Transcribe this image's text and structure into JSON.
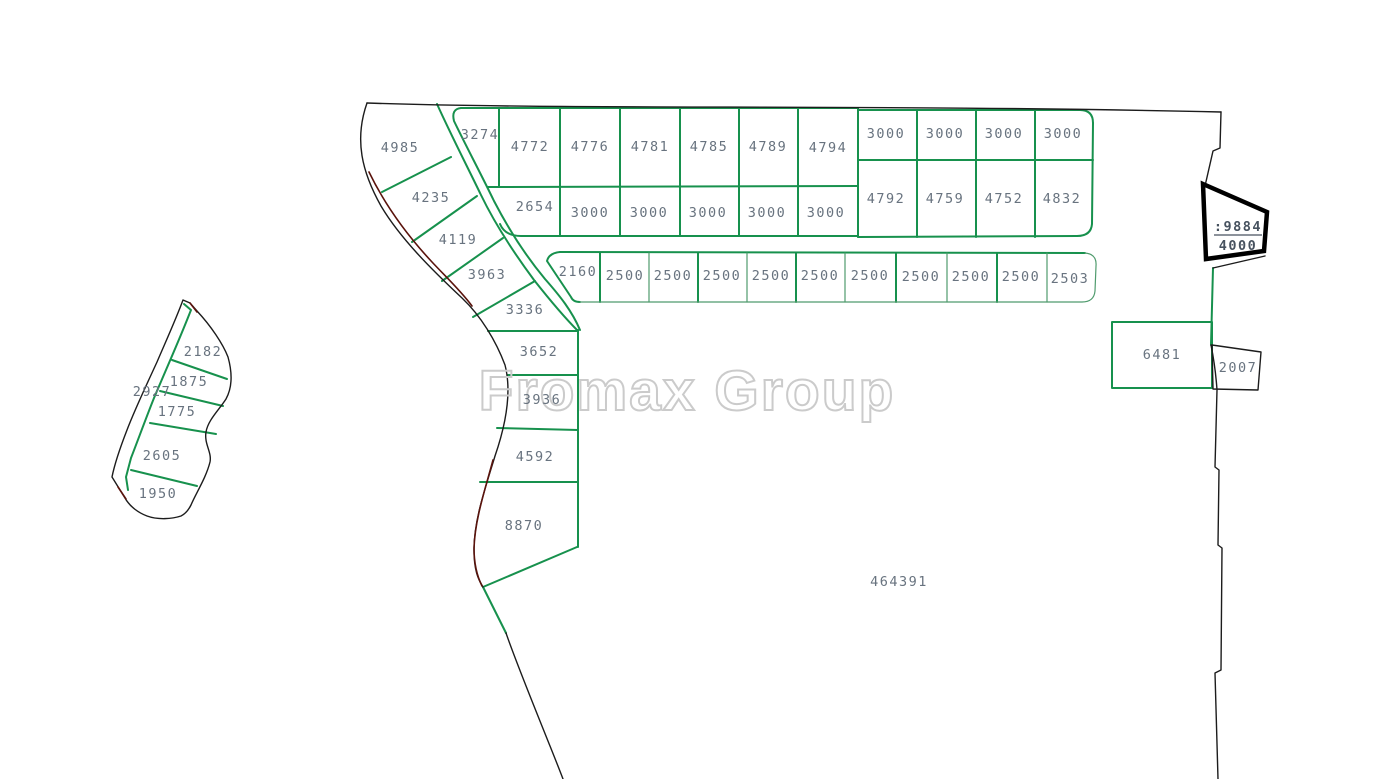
{
  "watermark": "Fromax Group",
  "colors": {
    "parcel_line": "#17914d",
    "parcel_line_thin": "#4f9b6d",
    "outer_boundary": "#1c1c1c",
    "boundary_accent": "#5a130c",
    "label_text": "#68737f",
    "highlight_text": "#47525f",
    "watermark_outline": "#cbcbcb",
    "background": "#ffffff"
  },
  "highlight_plot": {
    "label_top": ":9884",
    "label_bottom": "4000"
  },
  "zones": [
    {
      "name": "west-cluster",
      "plots": [
        {
          "area": "2182",
          "x": 203,
          "y": 356
        },
        {
          "area": "1875",
          "x": 189,
          "y": 386
        },
        {
          "area": "2927",
          "x": 152,
          "y": 396
        },
        {
          "area": "1775",
          "x": 177,
          "y": 416
        },
        {
          "area": "2605",
          "x": 162,
          "y": 460
        },
        {
          "area": "1950",
          "x": 158,
          "y": 498
        }
      ]
    },
    {
      "name": "northwest-column",
      "plots": [
        {
          "area": "4985",
          "x": 400,
          "y": 152
        },
        {
          "area": "4235",
          "x": 431,
          "y": 202
        },
        {
          "area": "4119",
          "x": 458,
          "y": 244
        },
        {
          "area": "3963",
          "x": 487,
          "y": 279
        },
        {
          "area": "3336",
          "x": 525,
          "y": 314
        }
      ]
    },
    {
      "name": "road-strip",
      "plots": [
        {
          "area": "3274",
          "x": 480,
          "y": 139
        },
        {
          "area": "2654",
          "x": 535,
          "y": 211
        }
      ]
    },
    {
      "name": "mid-column",
      "plots": [
        {
          "area": "3652",
          "x": 539,
          "y": 356
        },
        {
          "area": "3936",
          "x": 542,
          "y": 404
        },
        {
          "area": "4592",
          "x": 535,
          "y": 461
        },
        {
          "area": "8870",
          "x": 524,
          "y": 530
        }
      ]
    },
    {
      "name": "north-row-upper",
      "plots": [
        {
          "area": "4772",
          "x": 530,
          "y": 151
        },
        {
          "area": "4776",
          "x": 590,
          "y": 151
        },
        {
          "area": "4781",
          "x": 650,
          "y": 151
        },
        {
          "area": "4785",
          "x": 709,
          "y": 151
        },
        {
          "area": "4789",
          "x": 768,
          "y": 151
        },
        {
          "area": "4794",
          "x": 828,
          "y": 152
        }
      ]
    },
    {
      "name": "north-row-lower",
      "plots": [
        {
          "area": "3000",
          "x": 590,
          "y": 217
        },
        {
          "area": "3000",
          "x": 649,
          "y": 217
        },
        {
          "area": "3000",
          "x": 708,
          "y": 217
        },
        {
          "area": "3000",
          "x": 767,
          "y": 217
        },
        {
          "area": "3000",
          "x": 826,
          "y": 217
        }
      ]
    },
    {
      "name": "northeast-block-upper",
      "plots": [
        {
          "area": "3000",
          "x": 886,
          "y": 138
        },
        {
          "area": "3000",
          "x": 945,
          "y": 138
        },
        {
          "area": "3000",
          "x": 1004,
          "y": 138
        },
        {
          "area": "3000",
          "x": 1063,
          "y": 138
        }
      ]
    },
    {
      "name": "northeast-block-lower",
      "plots": [
        {
          "area": "4792",
          "x": 886,
          "y": 203
        },
        {
          "area": "4759",
          "x": 945,
          "y": 203
        },
        {
          "area": "4752",
          "x": 1004,
          "y": 203
        },
        {
          "area": "4832",
          "x": 1062,
          "y": 203
        }
      ]
    },
    {
      "name": "east-west-strip",
      "plots": [
        {
          "area": "2160",
          "x": 578,
          "y": 276
        },
        {
          "area": "2500",
          "x": 625,
          "y": 280
        },
        {
          "area": "2500",
          "x": 673,
          "y": 280
        },
        {
          "area": "2500",
          "x": 722,
          "y": 280
        },
        {
          "area": "2500",
          "x": 771,
          "y": 280
        },
        {
          "area": "2500",
          "x": 820,
          "y": 280
        },
        {
          "area": "2500",
          "x": 870,
          "y": 280
        },
        {
          "area": "2500",
          "x": 921,
          "y": 281
        },
        {
          "area": "2500",
          "x": 971,
          "y": 281
        },
        {
          "area": "2500",
          "x": 1021,
          "y": 281
        },
        {
          "area": "2503",
          "x": 1070,
          "y": 283
        }
      ]
    },
    {
      "name": "east-parcels",
      "plots": [
        {
          "area": "6481",
          "x": 1162,
          "y": 359
        },
        {
          "area": "2007",
          "x": 1238,
          "y": 372
        }
      ]
    },
    {
      "name": "central-parcel",
      "plots": [
        {
          "area": "464391",
          "x": 899,
          "y": 586
        }
      ]
    }
  ]
}
